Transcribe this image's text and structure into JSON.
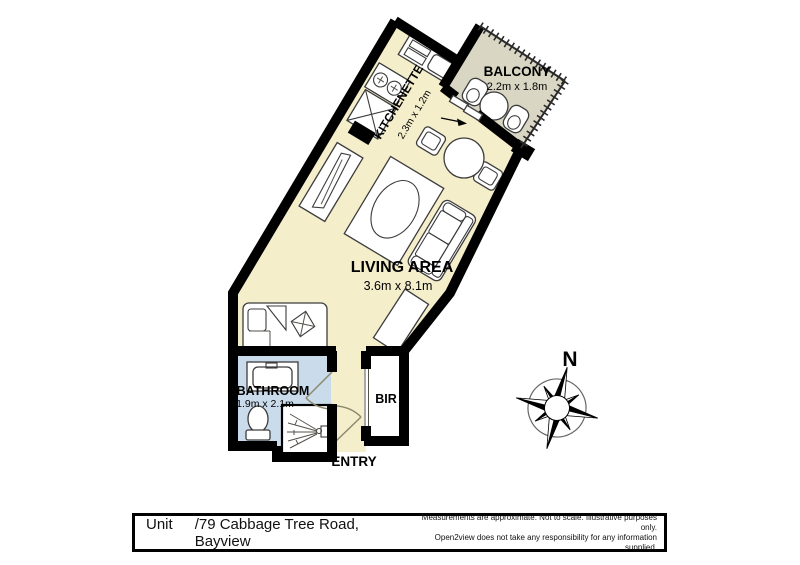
{
  "rooms": {
    "living": {
      "name": "LIVING AREA",
      "dims": "3.6m x 8.1m"
    },
    "kitchenette": {
      "name": "KITCHENETTE",
      "dims": "2.3m x 1.2m"
    },
    "balcony": {
      "name": "BALCONY",
      "dims": "2.2m x 1.8m"
    },
    "bathroom": {
      "name": "BATHROOM",
      "dims": "1.9m x 2.1m"
    },
    "bir": {
      "name": "BIR"
    },
    "entry": {
      "name": "ENTRY"
    }
  },
  "compass": {
    "north_label": "N"
  },
  "title_bar": {
    "unit_label": "Unit",
    "address": "/79 Cabbage Tree Road, Bayview",
    "disclaimer_line1": "Measurements are approximate. Not to scale. Illustrative purposes only.",
    "disclaimer_line2": "Open2view does not take any responsibility for any information supplied."
  },
  "colors": {
    "floor": "#f5eecb",
    "balcony": "#d9d6c3",
    "bath": "#cadcec",
    "wall": "#000000"
  }
}
